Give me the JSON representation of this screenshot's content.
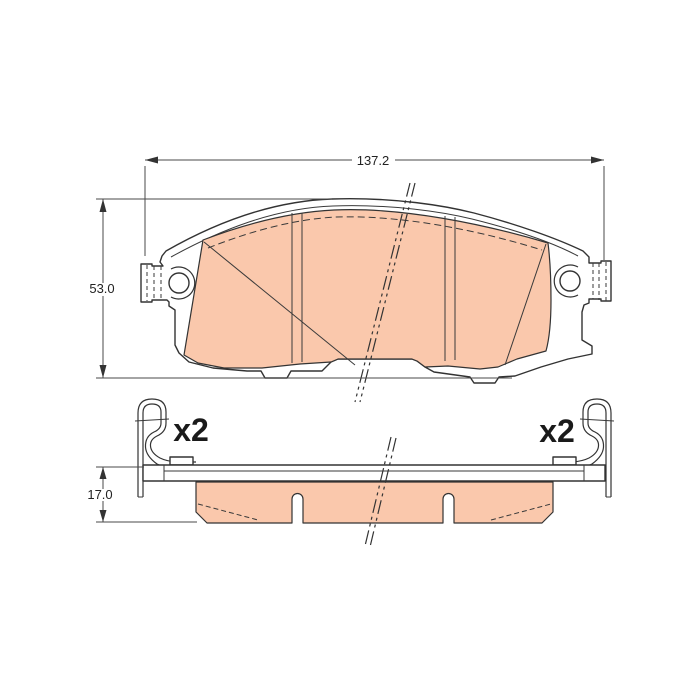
{
  "drawing": {
    "dimensions": {
      "width": "137.2",
      "height": "53.0",
      "thickness": "17.0"
    },
    "quantities": {
      "left": "x2",
      "right": "x2"
    },
    "colors": {
      "friction": "#FAC8AC",
      "line": "#333333",
      "background": "#FFFFFF"
    }
  }
}
